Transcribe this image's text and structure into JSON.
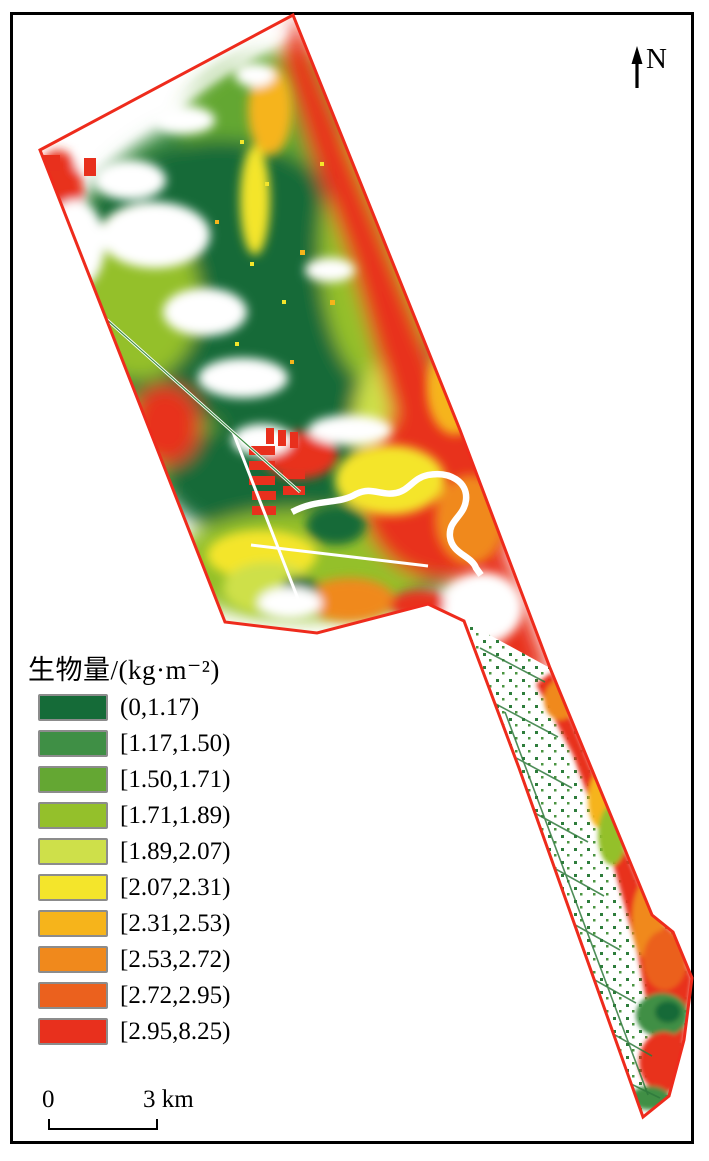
{
  "figure": {
    "type": "biomass-classification-map",
    "north_label": "N",
    "scale_bar": {
      "start_label": "0",
      "end_label": "3 km"
    },
    "legend": {
      "title": "生物量/(kg·m⁻²)",
      "items": [
        {
          "label": "(0,1.17)",
          "color": "#156B38"
        },
        {
          "label": "[1.17,1.50)",
          "color": "#3F8F45"
        },
        {
          "label": "[1.50,1.71)",
          "color": "#64A733"
        },
        {
          "label": "[1.71,1.89)",
          "color": "#94C02B"
        },
        {
          "label": "[1.89,2.07)",
          "color": "#CEE04A"
        },
        {
          "label": "[2.07,2.31)",
          "color": "#F4E52B"
        },
        {
          "label": "[2.31,2.53)",
          "color": "#F6B41B"
        },
        {
          "label": "[2.53,2.72)",
          "color": "#F0891C"
        },
        {
          "label": "[2.72,2.95)",
          "color": "#EB611E"
        },
        {
          "label": "[2.95,8.25)",
          "color": "#E8301D"
        }
      ]
    },
    "colors": {
      "boundary": "#EE2B1C",
      "frame": "#000000",
      "background": "#FFFFFF"
    }
  }
}
